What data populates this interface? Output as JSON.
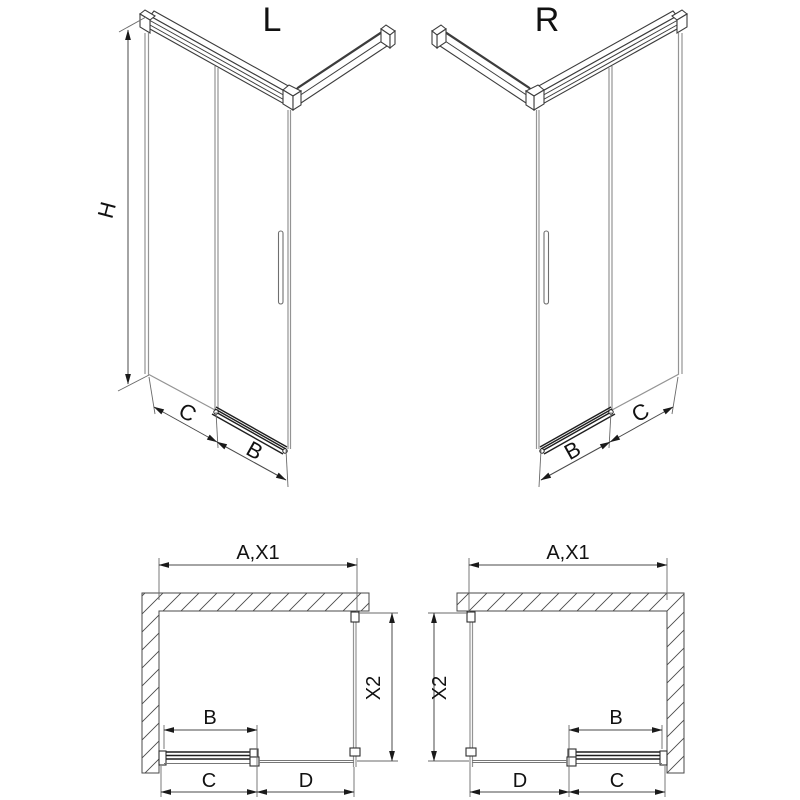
{
  "views": {
    "iso_left": {
      "label": "L",
      "dim_height": "H",
      "dim_panel": "C",
      "dim_door": "B"
    },
    "iso_right": {
      "label": "R",
      "dim_panel": "C",
      "dim_door": "B"
    },
    "plan_left": {
      "dim_width": "A,X1",
      "dim_depth": "X2",
      "dim_door": "B",
      "dim_bottom_left": "C",
      "dim_bottom_right": "D"
    },
    "plan_right": {
      "dim_width": "A,X1",
      "dim_depth": "X2",
      "dim_door": "B",
      "dim_bottom_left": "D",
      "dim_bottom_right": "C"
    }
  },
  "colors": {
    "background": "#ffffff",
    "frame_line": "#3c3c3c",
    "glass_line": "#949494",
    "dimension_line": "#4a4a4a",
    "text": "#111111"
  }
}
